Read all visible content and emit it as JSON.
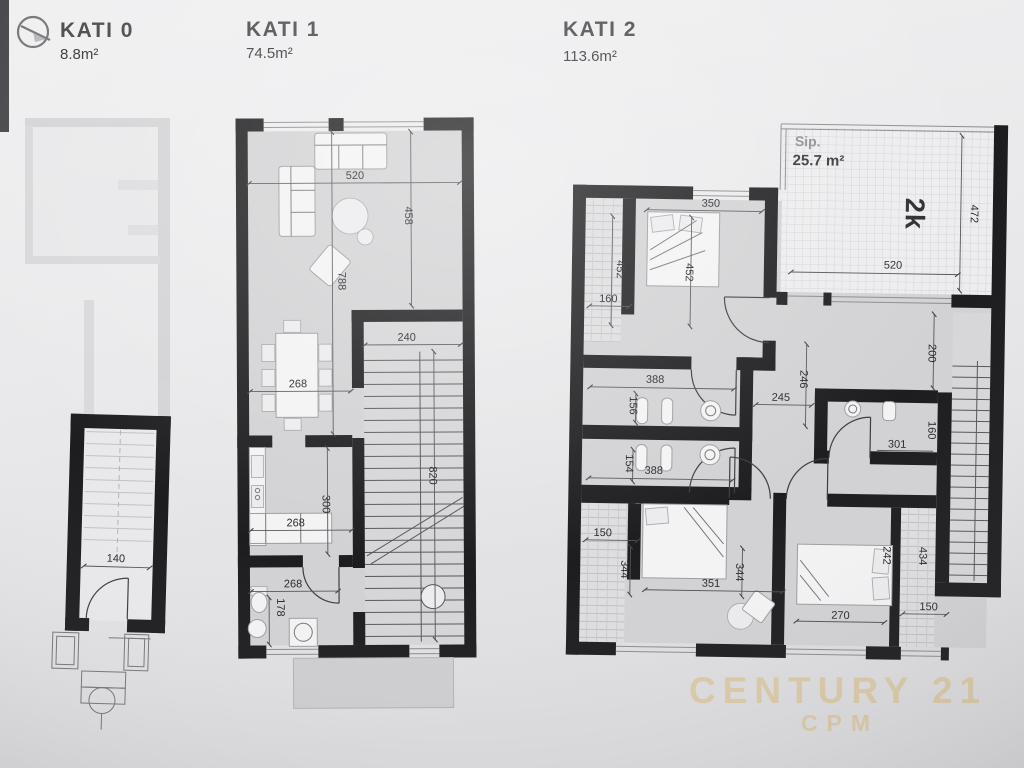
{
  "header": {
    "floors": [
      {
        "label": "KATI 0",
        "area": "8.8m²"
      },
      {
        "label": "KATI 1",
        "area": "74.5m²"
      },
      {
        "label": "KATI 2",
        "area": "113.6m²"
      }
    ],
    "north_icon": "compass-icon"
  },
  "kati2_terrace": {
    "label": "Sip.",
    "area": "25.7 m²",
    "code": "2k"
  },
  "watermark": {
    "brand": "CENTURY 21",
    "office": "CPM"
  },
  "dims": {
    "k0_140": "140",
    "k1_520": "520",
    "k1_458": "458",
    "k1_788": "788",
    "k1_240": "240",
    "k1_268_dining": "268",
    "k1_820": "820",
    "k1_300": "300",
    "k1_268_kitchen": "268",
    "k1_268_bath": "268",
    "k1_178": "178",
    "k2_350": "350",
    "k2_452_l": "452",
    "k2_452_r": "452",
    "k2_160_tl": "160",
    "k2_520": "520",
    "k2_472": "472",
    "k2_388_b1": "388",
    "k2_156": "156",
    "k2_388_b2": "388",
    "k2_154": "154",
    "k2_246": "246",
    "k2_245": "245",
    "k2_200": "200",
    "k2_301": "301",
    "k2_160_bath": "160",
    "k2_150_bl": "150",
    "k2_344_l": "344",
    "k2_351": "351",
    "k2_344_r": "344",
    "k2_242": "242",
    "k2_434": "434",
    "k2_270": "270",
    "k2_150_br": "150"
  }
}
